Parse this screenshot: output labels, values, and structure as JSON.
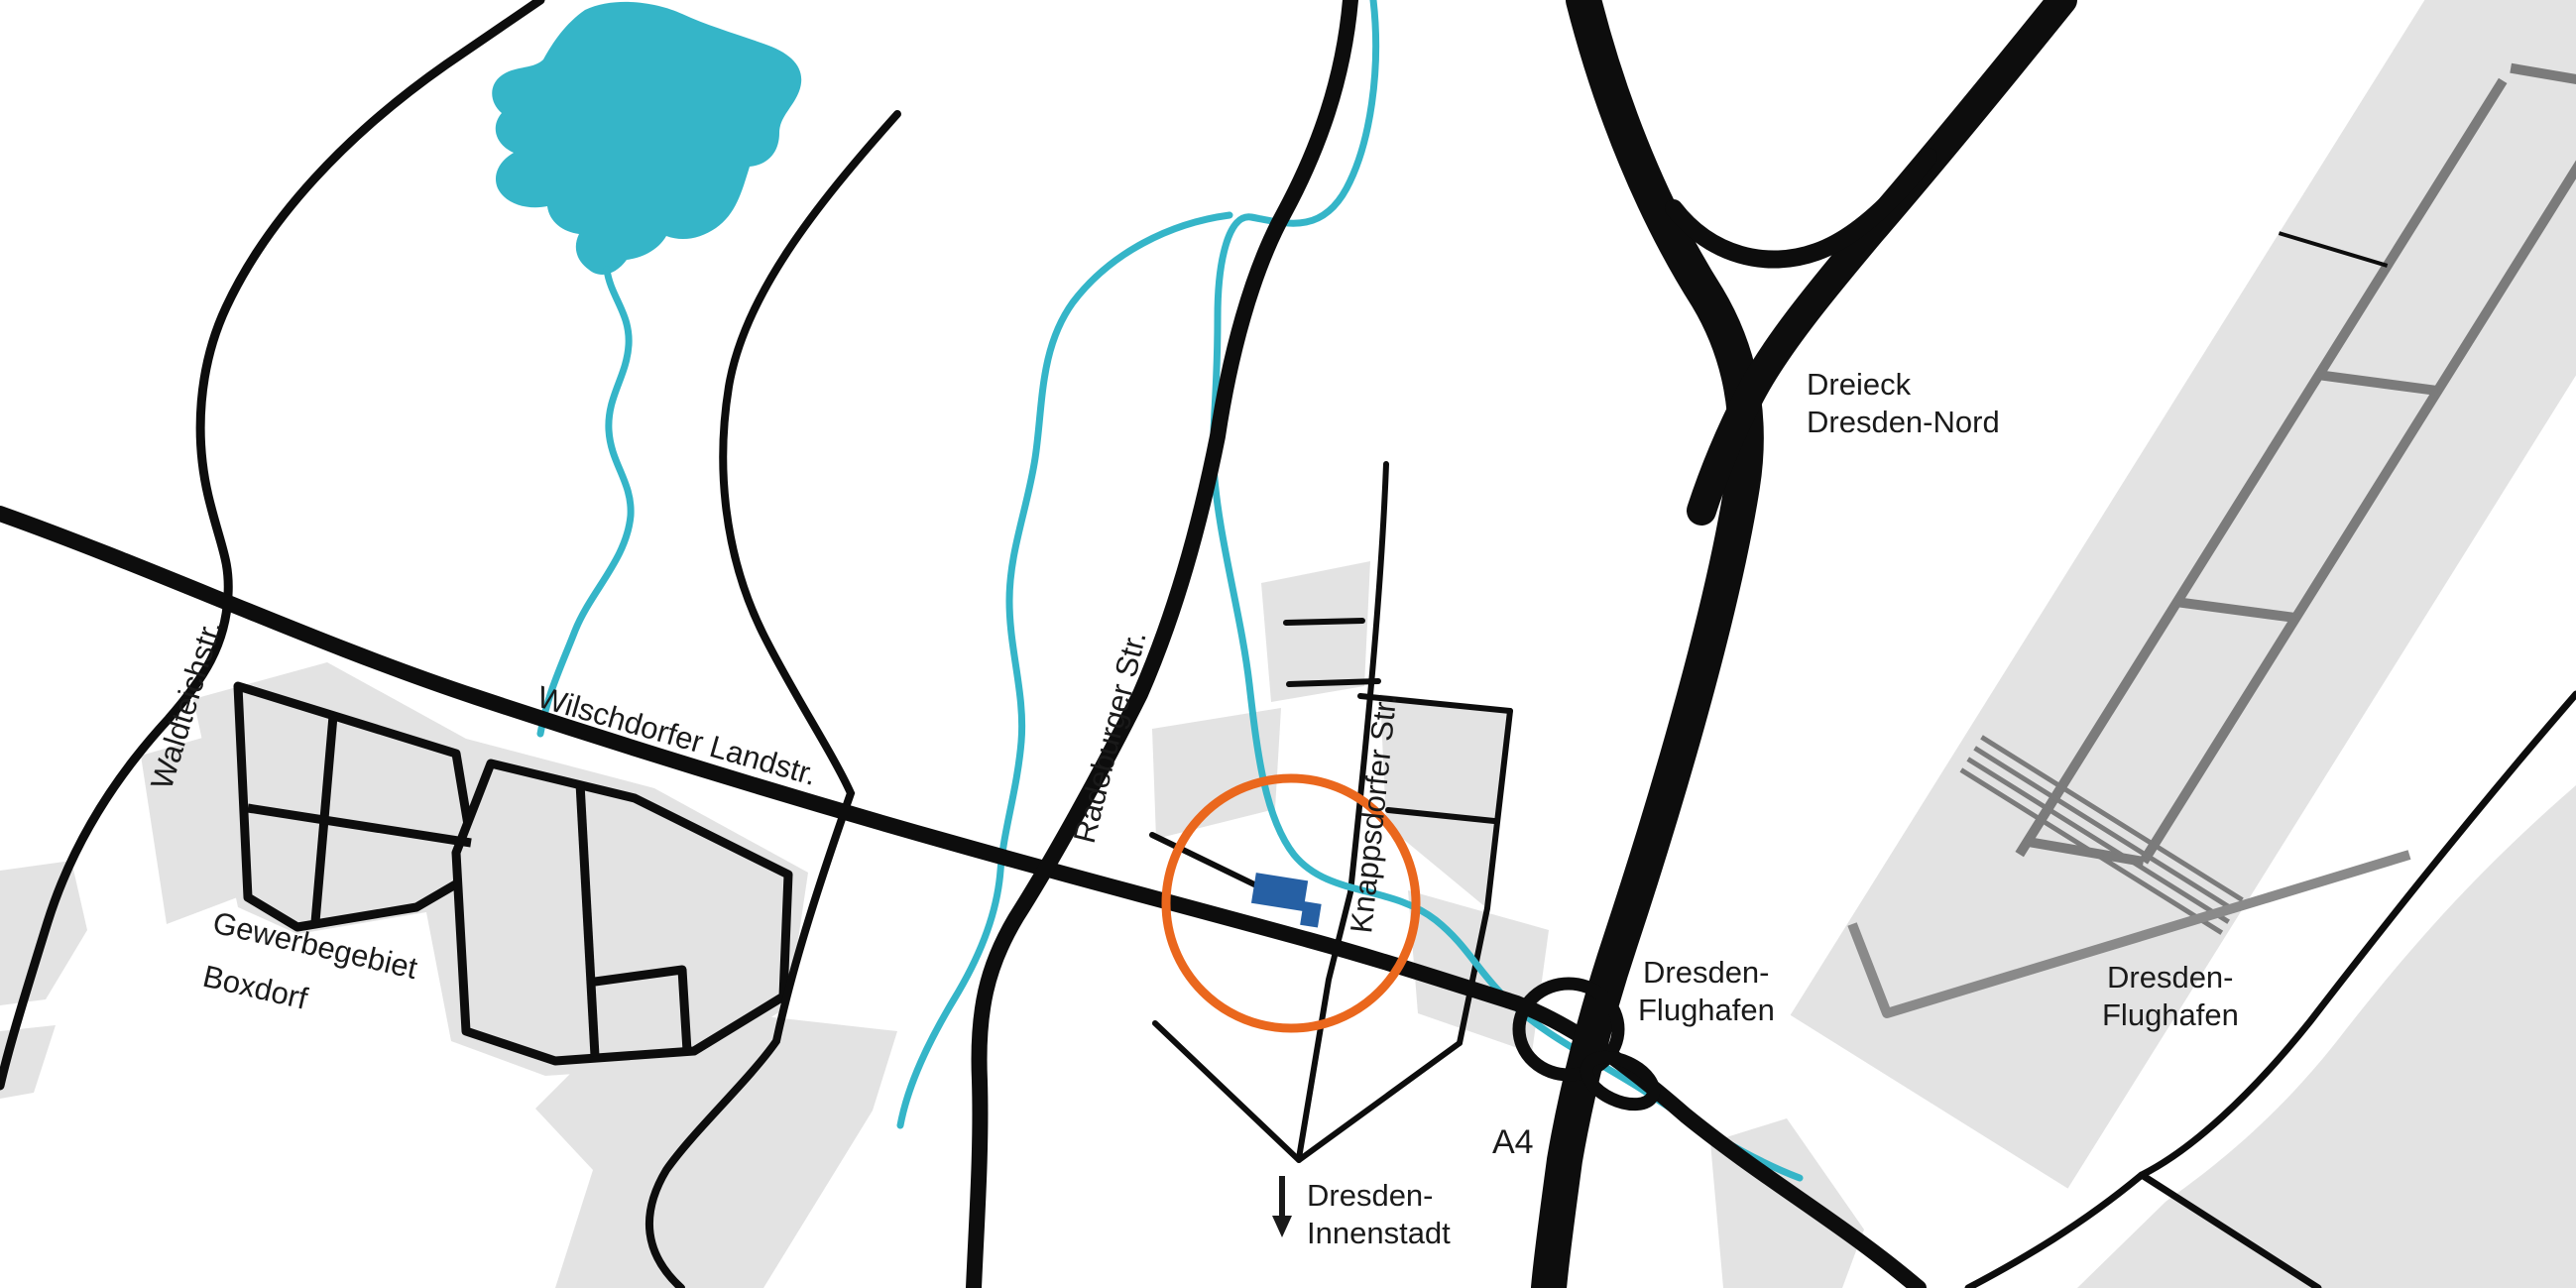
{
  "map": {
    "labels": {
      "waldteichstr": "Waldteichstr.",
      "wilschdorfer_landstr": "Wilschdorfer Landstr.",
      "gewerbegebiet_line1": "Gewerbegebiet",
      "gewerbegebiet_line2": "Boxdorf",
      "radeburger_str": "Radeburger Str.",
      "knappsdorfer_str": "Knappsdorfer Str.",
      "dreieck_line1": "Dreieck",
      "dreieck_line2": "Dresden-Nord",
      "flughafen_west_line1": "Dresden-",
      "flughafen_west_line2": "Flughafen",
      "flughafen_east_line1": "Dresden-",
      "flughafen_east_line2": "Flughafen",
      "a4": "A4",
      "innenstadt_line1": "Dresden-",
      "innenstadt_line2": "Innenstadt"
    },
    "colors": {
      "background": "#ffffff",
      "water": "#35b5c8",
      "area_gray": "#e3e3e3",
      "runway_gray": "#7b7b7b",
      "access_road_gray": "#8a8a8a",
      "road_black": "#0d0d0d",
      "highlight_orange": "#ea671d",
      "building_blue": "#2660a4",
      "label_text": "#1a1a1a"
    },
    "icons": {
      "down_arrow": "direction arrow pointing south to Dresden-Innenstadt"
    }
  }
}
